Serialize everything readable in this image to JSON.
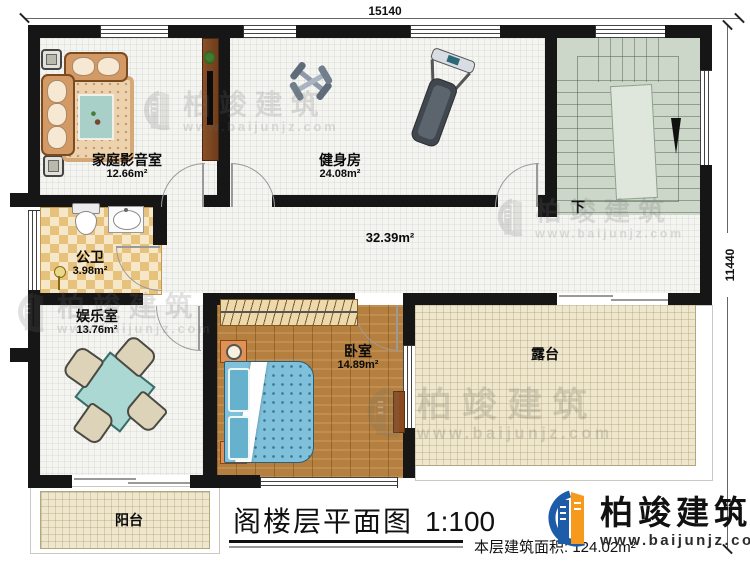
{
  "dimensions": {
    "top_width": "15140",
    "right_height": "11440"
  },
  "rooms": {
    "home_theater": {
      "name": "家庭影音室",
      "area": "12.66m²"
    },
    "gym": {
      "name": "健身房",
      "area": "24.08m²"
    },
    "bathroom": {
      "name": "公卫",
      "area": "3.98m²"
    },
    "hall": {
      "area": "32.39m²"
    },
    "entertainment": {
      "name": "娱乐室",
      "area": "13.76m²"
    },
    "bedroom": {
      "name": "卧室",
      "area": "14.89m²"
    },
    "terrace": {
      "name": "露台"
    },
    "balcony": {
      "name": "阳台"
    },
    "stairs": {
      "down_label": "下"
    }
  },
  "title_block": {
    "title": "阁楼层平面图",
    "scale": "1:100",
    "floor_area": "本层建筑面积: 124.02m²"
  },
  "brand": {
    "name": "柏竣建筑",
    "website": "www.baijunjz.com"
  },
  "watermark": {
    "name": "柏竣建筑",
    "website": "www.baijunjz.com"
  },
  "colors": {
    "wall": "#161616",
    "wood_floor": "#b5803f",
    "terrace_floor": "#eee7cd",
    "stair_floor": "#ccd6c9",
    "bathroom_tile": "#e7c27c",
    "bed": "#7fc0da",
    "table": "#abd8d3",
    "brand_blue": "#1c5ca8",
    "brand_orange": "#f59a1d"
  }
}
